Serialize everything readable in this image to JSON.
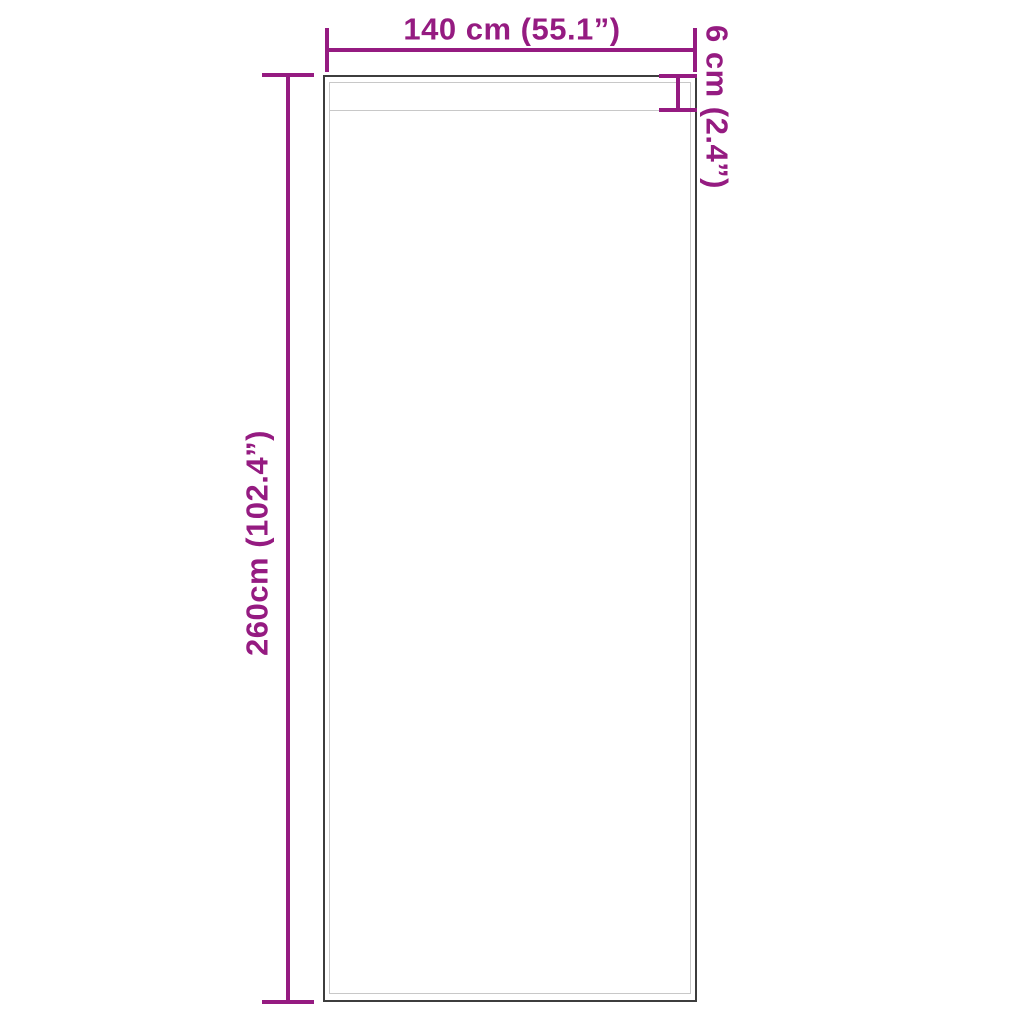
{
  "diagram": {
    "type": "product-dimension-drawing",
    "product": "curtain-panel-outline",
    "width_label": "140 cm (55.1”)",
    "height_label": "260cm (102.4”)",
    "pocket_label": "6 cm (2.4”)"
  },
  "colors": {
    "accent": "#951b81",
    "outline": "#3d3d3d",
    "innerline": "#c8c8c8",
    "bg": "#ffffff"
  }
}
